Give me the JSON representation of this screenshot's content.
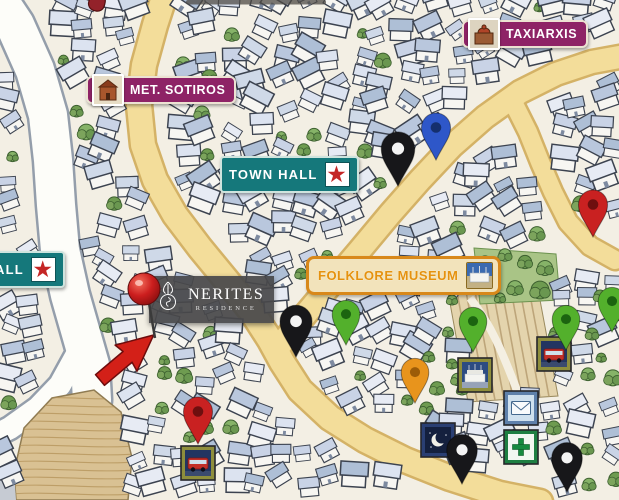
{
  "landmarks": {
    "met_sotiros": "MET. SOTIROS",
    "taxiarxis": "TAXIARXIS",
    "town_hall": "TOWN HALL",
    "town_hall_partial": "ALL",
    "folklore_museum": "FOLKLORE MUSEUM"
  },
  "residence": {
    "name": "NERITES",
    "subtitle": "RESIDENCE"
  },
  "map_markers": {
    "pins": [
      {
        "name": "map-pin-black-north",
        "color": "black",
        "x": 398,
        "y": 186,
        "s": 1.15
      },
      {
        "name": "map-pin-blue",
        "color": "blue",
        "x": 436,
        "y": 160,
        "s": 1.0
      },
      {
        "name": "map-pin-red-east",
        "color": "red",
        "x": 593,
        "y": 237,
        "s": 1.0
      },
      {
        "name": "map-pin-black-center",
        "color": "black",
        "x": 296,
        "y": 357,
        "s": 1.1
      },
      {
        "name": "map-pin-green-center",
        "color": "green",
        "x": 346,
        "y": 345,
        "s": 0.95
      },
      {
        "name": "map-pin-orange",
        "color": "orange",
        "x": 415,
        "y": 403,
        "s": 0.95
      },
      {
        "name": "map-pin-green-garden",
        "color": "green",
        "x": 473,
        "y": 352,
        "s": 0.95
      },
      {
        "name": "map-pin-green-east",
        "color": "green",
        "x": 566,
        "y": 350,
        "s": 0.95
      },
      {
        "name": "map-pin-green-far-east",
        "color": "green",
        "x": 612,
        "y": 332,
        "s": 0.95
      },
      {
        "name": "map-pin-red-southwest",
        "color": "red",
        "x": 198,
        "y": 444,
        "s": 1.0
      },
      {
        "name": "map-pin-black-south",
        "color": "black",
        "x": 462,
        "y": 484,
        "s": 1.05
      },
      {
        "name": "map-pin-black-southeast",
        "color": "black",
        "x": 567,
        "y": 492,
        "s": 1.05
      }
    ],
    "pin_colors": {
      "black": [
        "#17171a",
        "#f4f4f4"
      ],
      "blue": [
        "#2e57c9",
        "#152f6e"
      ],
      "red": [
        "#c92121",
        "#6e0f0f"
      ],
      "green": [
        "#53b02c",
        "#1c6410"
      ],
      "orange": [
        "#e8941c",
        "#9c5c08"
      ]
    },
    "photo_markers": [
      {
        "name": "photo-marker-building",
        "type": "building",
        "x": 458,
        "y": 358,
        "border": "#8e8e3c"
      },
      {
        "name": "photo-marker-bus-east",
        "type": "bus",
        "x": 537,
        "y": 337,
        "border": "#8e8e3c"
      },
      {
        "name": "photo-marker-bus-west",
        "type": "bus",
        "x": 181,
        "y": 446,
        "border": "#8e8e3c"
      },
      {
        "name": "photo-marker-night",
        "type": "moon",
        "x": 421,
        "y": 423,
        "border": "#2a3f73"
      },
      {
        "name": "photo-marker-post",
        "type": "envelope",
        "x": 504,
        "y": 391,
        "border": "#5e80ab"
      },
      {
        "name": "photo-marker-pharmacy",
        "type": "cross",
        "x": 504,
        "y": 430,
        "border": "#1e7f42"
      }
    ],
    "red_ball": {
      "name": "nerites-location-ball",
      "x": 144,
      "y": 289,
      "r": 16
    },
    "arrow": {
      "name": "nerites-pointer-arrow",
      "x": 100,
      "y": 380,
      "angle": -40
    }
  },
  "colors": {
    "purple_badge": "#8e2366",
    "teal_badge": "#15787b",
    "orange_badge_border": "#d8881a",
    "orange_badge_bg": "#f2e3bb",
    "orange_text": "#e5920f",
    "star_red": "#c42525",
    "road_yellow": "#f3dd9a",
    "arrow_red": "#d32018",
    "nerites_bg": "rgba(72,72,74,0.93)"
  },
  "glyphs": {
    "star": "★"
  }
}
